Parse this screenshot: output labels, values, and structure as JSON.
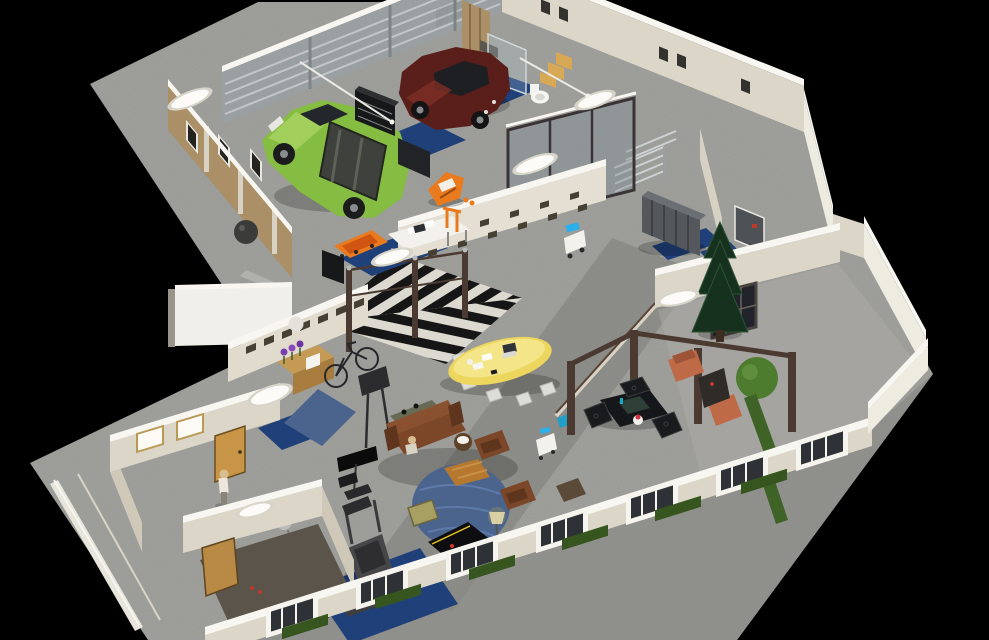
{
  "scene": {
    "description": "Isometric 3D cutaway render of a loft / workshop floor plan on a black background",
    "background": "#000000",
    "projection": "isometric-overhead"
  },
  "colors": {
    "background": "#000000",
    "slab": "#a1a19d",
    "sidewalk": "#8f8f8b",
    "walkway": "#8a8a86",
    "terrace_floor": "#b0aea8",
    "wall_face": "#dbd6c8",
    "wall_bright": "#f0efe9",
    "wall_cap": "#f8f6f0",
    "garage_door_wall": "#9aa0a2",
    "garage_door_slat": "#c2c6c8",
    "wood_wall": "#ab8f66",
    "window_dark": "#25231e",
    "door_tan": "#c89546",
    "door_wood": "#b98a45",
    "door_gray": "#4e5257",
    "suv_body": "#85bc42",
    "suv_hood": "#a2cf5b",
    "suv_cargo": "#3f423c",
    "car_body": "#5a1f1a",
    "car_glass": "#1d1f23",
    "mat_blue": "#20407a",
    "rug_blue": "#4a648e",
    "table_yellow": "#ecd65e",
    "table_yellow_top": "#f4e688",
    "sofa_brown": "#7b4728",
    "sofa_dark": "#5f351d",
    "console_olive": "#676b55",
    "coffee_wood": "#b5782e",
    "chair_wicker": "#a89f63",
    "tree_green": "#17311f",
    "bush_green": "#4e7c2f",
    "hedge_green": "#36551f",
    "grass_green": "#3f6326",
    "pergola_brown": "#4a3a32",
    "terracotta": "#bf6a47",
    "locker_gray": "#54585d",
    "glass_tint": "#7b8b92",
    "chevron_light": "#dcd9d0",
    "chevron_dark": "#161616",
    "orange_gear": "#ea7a1e",
    "orange_deep": "#d05510",
    "white_item": "#f2f1ec",
    "silver": "#b9babb",
    "screen_blue": "#2bb0ec",
    "lamp_warm": "#d8cfa4",
    "skin": "#d9bd92",
    "shirt": "#ece7da",
    "red_accent": "#c0392b",
    "treadmill_gray": "#474749",
    "black_item": "#17181a",
    "pinball_art_yellow": "#e0c83e",
    "pinball_art_purple": "#8a4a9e",
    "gumball": [
      "#d03828",
      "#2b62c8",
      "#e8c522",
      "#2f9e3f",
      "#e06a1e",
      "#8a3fae",
      "#18a8b8",
      "#d8d8d8"
    ]
  },
  "areas": [
    {
      "name": "garage",
      "objects": [
        "green-suv-with-roof-cargo",
        "maroon-sedan",
        "blue-service-mats",
        "black-tool-cabinets",
        "white-workbench",
        "orange-jetski",
        "orange-creeper-board",
        "garage-door-wall",
        "wood-panel-wall",
        "dark-ball"
      ]
    },
    {
      "name": "bathroom",
      "objects": [
        "toilet",
        "wood-shower-wall",
        "glass-shower-screen",
        "wood-step-shelves"
      ]
    },
    {
      "name": "storage-room",
      "objects": [
        "metal-shelving-rack",
        "glass-partition-wall"
      ]
    },
    {
      "name": "locker-room",
      "objects": [
        "gray-lockers",
        "blue-mats",
        "dark-door-with-red-sign",
        "tan-door"
      ]
    },
    {
      "name": "entry-hall",
      "objects": [
        "black-white-chevron-floor",
        "turnstile-gates",
        "cubby-niche-walls",
        "reception-desk",
        "purple-flowers",
        "white-box",
        "bicycle",
        "display-stand",
        "blue-rug",
        "bright-wall-panel",
        "service-robot-cart"
      ]
    },
    {
      "name": "lounge",
      "objects": [
        "yellow-surfboard-table",
        "white-chairs",
        "laptop",
        "papers",
        "leather-sofa",
        "leather-armchairs",
        "round-blue-rug",
        "wood-coffee-table",
        "tv-on-stand",
        "floor-lamp",
        "side-table",
        "wicker-chair",
        "seated-person",
        "service-cart",
        "teal-chair"
      ]
    },
    {
      "name": "gym",
      "objects": [
        "treadmill",
        "weight-bench",
        "barbell",
        "dumbbell-rack-colored",
        "blue-gym-mat",
        "pinball-machine",
        "black-arcade-wedge",
        "silver-ball-lamp"
      ]
    },
    {
      "name": "terrace",
      "objects": [
        "pergola-frame",
        "dark-dining-table",
        "hex-pattern-chairs",
        "cake-stand",
        "terracotta-loungers",
        "dark-cabinet",
        "conifer-tree",
        "round-bush",
        "grass-strips",
        "dark-grid-window"
      ]
    },
    {
      "name": "offices",
      "objects": [
        "tan-door",
        "white-windows",
        "standing-person",
        "wood-door",
        "dark-floor-room",
        "oval-ceiling-lights"
      ]
    },
    {
      "name": "exterior",
      "objects": [
        "concrete-apron",
        "sidewalk",
        "facade-window-wall",
        "hedge-rows",
        "white-parapet-wall"
      ]
    }
  ]
}
